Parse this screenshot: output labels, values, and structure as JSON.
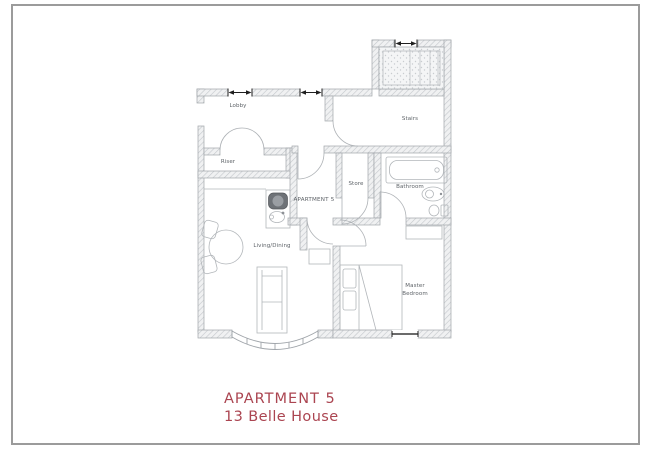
{
  "page": {
    "background": "#ffffff",
    "border_color": "#9b9b9b"
  },
  "plan": {
    "line_color": "#a0a5aa",
    "label_color": "#5d6267",
    "detail_color": "#1f1f1f",
    "labels": {
      "lobby": "Lobby",
      "stairs": "Stairs",
      "riser": "Riser",
      "store": "Store",
      "bathroom": "Bathroom",
      "hall": "APARTMENT 5",
      "living_dining": "Living/Dining",
      "master_bedroom_line1": "Master",
      "master_bedroom_line2": "Bedroom"
    }
  },
  "caption": {
    "title": "APARTMENT 5",
    "subtitle": "13 Belle House",
    "color": "#ab4551"
  }
}
